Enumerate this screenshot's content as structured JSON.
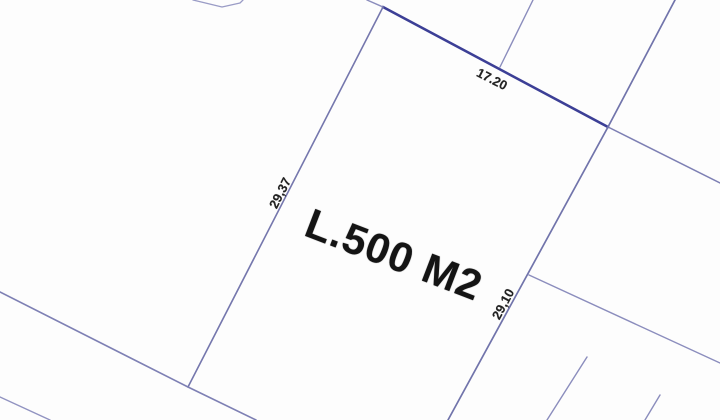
{
  "diagram": {
    "type": "cadastral-parcel-plan",
    "background_color": "#fdfdfd",
    "line_color_primary": "#7174ab",
    "line_color_dark": "#3c3f96",
    "line_color_faint": "#9a9cc6",
    "text_color": "#1b1b1b",
    "labels": {
      "area": "L.500 M2",
      "dim_top": "17.20",
      "dim_left": "29,37",
      "dim_right": "29,10"
    },
    "parcel": {
      "area_value": "500",
      "area_unit": "M2",
      "side_lengths": {
        "top": "17.20",
        "left": "29,37",
        "right": "29,10"
      }
    },
    "lines": [
      {
        "name": "top-boundary",
        "stroke": "#3c3f96",
        "width": 2.6,
        "points": [
          [
            383,
            7
          ],
          [
            608,
            127
          ]
        ]
      },
      {
        "name": "top-boundary-extension-left",
        "stroke": "#8b8dbd",
        "width": 1.4,
        "points": [
          [
            367,
            0
          ],
          [
            383,
            7
          ]
        ]
      },
      {
        "name": "top-boundary-extension-right",
        "stroke": "#7e80b4",
        "width": 1.5,
        "points": [
          [
            608,
            127
          ],
          [
            720,
            183
          ]
        ]
      },
      {
        "name": "left-boundary",
        "stroke": "#7577ad",
        "width": 1.6,
        "points": [
          [
            383,
            7
          ],
          [
            188,
            387
          ]
        ]
      },
      {
        "name": "right-boundary",
        "stroke": "#7174ab",
        "width": 1.7,
        "points": [
          [
            675,
            0
          ],
          [
            608,
            127
          ],
          [
            448,
            420
          ]
        ]
      },
      {
        "name": "upper-cross-line",
        "stroke": "#8b8dbd",
        "width": 1.4,
        "points": [
          [
            533,
            0
          ],
          [
            500,
            67
          ]
        ]
      },
      {
        "name": "road-line",
        "stroke": "#7e80b4",
        "width": 1.6,
        "points": [
          [
            0,
            292
          ],
          [
            188,
            387
          ],
          [
            256,
            420
          ]
        ]
      },
      {
        "name": "road-line-lower",
        "stroke": "#9193c1",
        "width": 1.4,
        "points": [
          [
            0,
            397
          ],
          [
            50,
            420
          ]
        ]
      },
      {
        "name": "east-branch-line",
        "stroke": "#8b8dbd",
        "width": 1.4,
        "points": [
          [
            529,
            275
          ],
          [
            720,
            363
          ]
        ]
      },
      {
        "name": "south-tick-line-1",
        "stroke": "#8b8dbd",
        "width": 1.4,
        "points": [
          [
            587,
            357
          ],
          [
            547,
            420
          ]
        ]
      },
      {
        "name": "south-tick-line-2",
        "stroke": "#8b8dbd",
        "width": 1.4,
        "points": [
          [
            660,
            395
          ],
          [
            645,
            420
          ]
        ]
      },
      {
        "name": "north-parcel-outline",
        "stroke": "#9a9cc6",
        "width": 1.3,
        "points": [
          [
            193,
            0
          ],
          [
            222,
            7
          ],
          [
            240,
            3
          ],
          [
            243,
            0
          ]
        ]
      }
    ]
  }
}
